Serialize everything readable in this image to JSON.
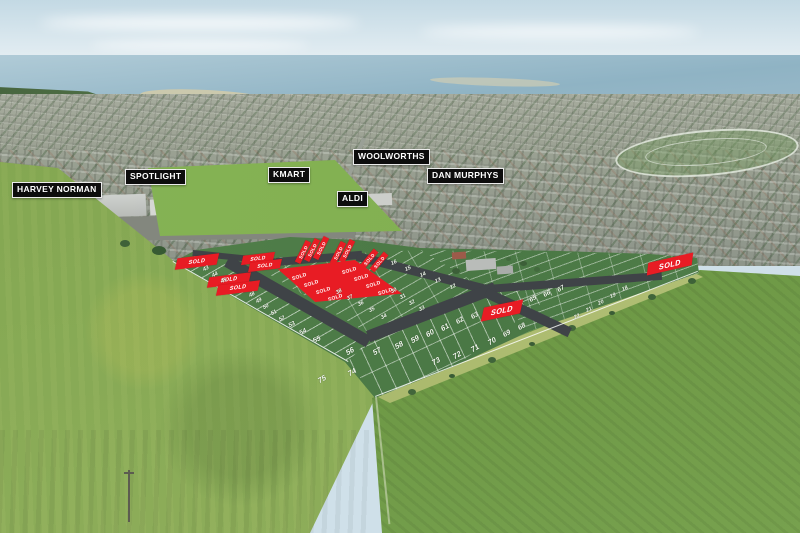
{
  "store_labels": [
    {
      "text": "HARVEY NORMAN",
      "x": 12,
      "y": 182
    },
    {
      "text": "SPOTLIGHT",
      "x": 125,
      "y": 169
    },
    {
      "text": "KMART",
      "x": 268,
      "y": 167
    },
    {
      "text": "WOOLWORTHS",
      "x": 353,
      "y": 149
    },
    {
      "text": "DAN MURPHYS",
      "x": 427,
      "y": 168
    },
    {
      "text": "ALDI",
      "x": 337,
      "y": 191
    }
  ],
  "estate": {
    "sold_text": "SOLD",
    "colors": {
      "sold": "#e81c24",
      "lot_line": "#ffffff",
      "grass": "#4e7c47",
      "road": "#3f4347"
    },
    "lot_numbers": [
      {
        "n": "43",
        "x": 206,
        "y": 269,
        "r": -28,
        "s": 5.5
      },
      {
        "n": "44",
        "x": 215,
        "y": 275,
        "r": -28,
        "s": 5.5
      },
      {
        "n": "45",
        "x": 224,
        "y": 281,
        "r": -28,
        "s": 5.5
      },
      {
        "n": "48",
        "x": 252,
        "y": 295,
        "r": -28,
        "s": 5.5
      },
      {
        "n": "49",
        "x": 259,
        "y": 301,
        "r": -28,
        "s": 5.5
      },
      {
        "n": "50",
        "x": 266,
        "y": 307,
        "r": -28,
        "s": 5.5
      },
      {
        "n": "51",
        "x": 274,
        "y": 313,
        "r": -28,
        "s": 5.5
      },
      {
        "n": "52",
        "x": 282,
        "y": 319,
        "r": -28,
        "s": 5.5
      },
      {
        "n": "53",
        "x": 292,
        "y": 325,
        "r": -28,
        "s": 6
      },
      {
        "n": "54",
        "x": 303,
        "y": 332,
        "r": -28,
        "s": 6.5
      },
      {
        "n": "55",
        "x": 317,
        "y": 340,
        "r": -28,
        "s": 7
      },
      {
        "n": "56",
        "x": 350,
        "y": 351,
        "r": -30,
        "s": 7.5
      },
      {
        "n": "57",
        "x": 377,
        "y": 351,
        "r": -30,
        "s": 7.5
      },
      {
        "n": "58",
        "x": 399,
        "y": 345,
        "r": -30,
        "s": 7.5
      },
      {
        "n": "59",
        "x": 415,
        "y": 339,
        "r": -30,
        "s": 7.5
      },
      {
        "n": "60",
        "x": 430,
        "y": 333,
        "r": -30,
        "s": 7.5
      },
      {
        "n": "61",
        "x": 445,
        "y": 327,
        "r": -30,
        "s": 7.5
      },
      {
        "n": "62",
        "x": 460,
        "y": 321,
        "r": -30,
        "s": 7
      },
      {
        "n": "63",
        "x": 475,
        "y": 316,
        "r": -30,
        "s": 7
      },
      {
        "n": "65",
        "x": 533,
        "y": 299,
        "r": -30,
        "s": 6.5
      },
      {
        "n": "66",
        "x": 547,
        "y": 294,
        "r": -30,
        "s": 6.5
      },
      {
        "n": "67",
        "x": 561,
        "y": 289,
        "r": -30,
        "s": 6.5
      },
      {
        "n": "68",
        "x": 522,
        "y": 327,
        "r": -30,
        "s": 7
      },
      {
        "n": "69",
        "x": 507,
        "y": 334,
        "r": -30,
        "s": 7
      },
      {
        "n": "70",
        "x": 492,
        "y": 341,
        "r": -30,
        "s": 7.5
      },
      {
        "n": "71",
        "x": 475,
        "y": 348,
        "r": -30,
        "s": 7.5
      },
      {
        "n": "72",
        "x": 457,
        "y": 355,
        "r": -30,
        "s": 7.5
      },
      {
        "n": "73",
        "x": 436,
        "y": 361,
        "r": -30,
        "s": 7.5
      },
      {
        "n": "74",
        "x": 352,
        "y": 372,
        "r": -30,
        "s": 7.5
      },
      {
        "n": "75",
        "x": 322,
        "y": 379,
        "r": -30,
        "s": 7.5
      },
      {
        "n": "38",
        "x": 339,
        "y": 292,
        "r": -28,
        "s": 5.5
      },
      {
        "n": "37",
        "x": 350,
        "y": 298,
        "r": -28,
        "s": 5.5
      },
      {
        "n": "36",
        "x": 361,
        "y": 304,
        "r": -28,
        "s": 5.5
      },
      {
        "n": "35",
        "x": 372,
        "y": 310,
        "r": -28,
        "s": 5.5
      },
      {
        "n": "34",
        "x": 384,
        "y": 317,
        "r": -28,
        "s": 5.5
      },
      {
        "n": "30",
        "x": 394,
        "y": 291,
        "r": -28,
        "s": 5.5
      },
      {
        "n": "31",
        "x": 403,
        "y": 297,
        "r": -28,
        "s": 5.5
      },
      {
        "n": "32",
        "x": 412,
        "y": 303,
        "r": -28,
        "s": 5.5
      },
      {
        "n": "33",
        "x": 422,
        "y": 309,
        "r": -28,
        "s": 5.5
      },
      {
        "n": "16",
        "x": 394,
        "y": 263,
        "r": -25,
        "s": 5.5
      },
      {
        "n": "15",
        "x": 408,
        "y": 269,
        "r": -25,
        "s": 5.5
      },
      {
        "n": "14",
        "x": 423,
        "y": 275,
        "r": -25,
        "s": 5.5
      },
      {
        "n": "13",
        "x": 438,
        "y": 281,
        "r": -25,
        "s": 5.5
      },
      {
        "n": "12",
        "x": 453,
        "y": 287,
        "r": -25,
        "s": 5.5
      },
      {
        "n": "18",
        "x": 625,
        "y": 289,
        "r": -25,
        "s": 5.5
      },
      {
        "n": "19",
        "x": 613,
        "y": 296,
        "r": -25,
        "s": 5.5
      },
      {
        "n": "20",
        "x": 601,
        "y": 303,
        "r": -25,
        "s": 5.5
      },
      {
        "n": "21",
        "x": 589,
        "y": 310,
        "r": -25,
        "s": 5.5
      },
      {
        "n": "22",
        "x": 577,
        "y": 317,
        "r": -25,
        "s": 5.5
      }
    ],
    "sold_lots": [
      {
        "cx": 197,
        "cy": 261,
        "w": 42,
        "h": 11,
        "r": -7,
        "skew": -20,
        "fs": 5.5
      },
      {
        "cx": 229,
        "cy": 280,
        "w": 42,
        "h": 10,
        "r": -7,
        "skew": -20,
        "fs": 5.5
      },
      {
        "cx": 238,
        "cy": 288,
        "w": 42,
        "h": 10,
        "r": -7,
        "skew": -20,
        "fs": 5.5
      },
      {
        "cx": 258,
        "cy": 258,
        "w": 32,
        "h": 9,
        "r": -7,
        "skew": -20,
        "fs": 5
      },
      {
        "cx": 265,
        "cy": 265,
        "w": 32,
        "h": 9,
        "r": -7,
        "skew": -20,
        "fs": 5
      },
      {
        "cx": 303,
        "cy": 252,
        "w": 24,
        "h": 6,
        "r": -63,
        "skew": 0,
        "fs": 4.5
      },
      {
        "cx": 312,
        "cy": 250,
        "w": 24,
        "h": 6,
        "r": -63,
        "skew": 0,
        "fs": 4.5
      },
      {
        "cx": 321,
        "cy": 248,
        "w": 24,
        "h": 6,
        "r": -63,
        "skew": 0,
        "fs": 4.5
      },
      {
        "cx": 338,
        "cy": 253,
        "w": 24,
        "h": 6,
        "r": -63,
        "skew": 0,
        "fs": 4.5
      },
      {
        "cx": 347,
        "cy": 251,
        "w": 24,
        "h": 6,
        "r": -63,
        "skew": 0,
        "fs": 4.5
      },
      {
        "cx": 369,
        "cy": 259,
        "w": 22,
        "h": 6,
        "r": -50,
        "skew": 0,
        "fs": 4.5
      },
      {
        "cx": 379,
        "cy": 262,
        "w": 22,
        "h": 6,
        "r": -50,
        "skew": 0,
        "fs": 4.5
      },
      {
        "cx": 502,
        "cy": 310,
        "w": 40,
        "h": 13,
        "r": -12,
        "skew": -25,
        "fs": 7.5
      },
      {
        "cx": 670,
        "cy": 264,
        "w": 46,
        "h": 12,
        "r": -13,
        "skew": -20,
        "fs": 7.5
      }
    ],
    "sold_cluster": {
      "x": 278,
      "y": 260,
      "w": 124,
      "h": 42,
      "clip": "polygon(0% 22%, 62% 0%, 100% 80%, 30% 100%)",
      "r": -18,
      "fs": 5,
      "labels": [
        {
          "x": 14,
          "y": 14
        },
        {
          "x": 26,
          "y": 21
        },
        {
          "x": 38,
          "y": 28
        },
        {
          "x": 50,
          "y": 35
        },
        {
          "x": 64,
          "y": 8
        },
        {
          "x": 76,
          "y": 15
        },
        {
          "x": 88,
          "y": 22
        },
        {
          "x": 100,
          "y": 29
        }
      ]
    }
  }
}
